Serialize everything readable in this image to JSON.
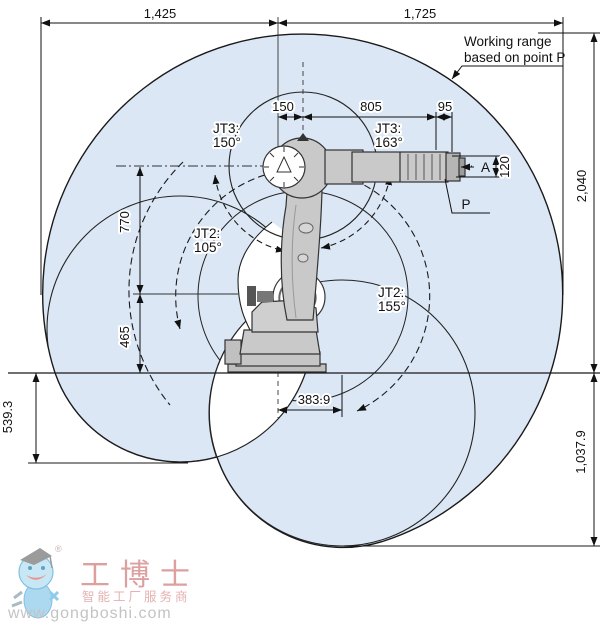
{
  "annotations": {
    "working_range": [
      "Working range",
      "based on point P"
    ],
    "point_a": "A",
    "point_p": "P"
  },
  "dims": {
    "reach_back": "1,425",
    "reach_forward": "1,725",
    "jt1_offset": "150",
    "forearm": "805",
    "wrist_to_p": "95",
    "flange_width": "120",
    "total_height": "2,040",
    "upper_arm": "770",
    "shoulder_height": "465",
    "depth_left": "539.3",
    "bottom_offset": "383.9",
    "depth_right": "1,037.9"
  },
  "joints": {
    "jt3_left": {
      "label": "JT3:",
      "angle": "150°"
    },
    "jt3_right": {
      "label": "JT3:",
      "angle": "163°"
    },
    "jt2_left": {
      "label": "JT2:",
      "angle": "105°"
    },
    "jt2_right": {
      "label": "JT2:",
      "angle": "155°"
    }
  },
  "watermark": {
    "reg": "®",
    "brand": "工博士",
    "tagline": "智能工厂服务商",
    "url": "www.gongboshi.com"
  },
  "colors": {
    "envelope_fill": "#dbe7f5",
    "outline": "#1a1a1a",
    "robot_fill": "#c9c9c9",
    "robot_dark": "#9d9d9d",
    "watermark_red": "#d98f8f",
    "watermark_gray": "#b9b9b9",
    "watermark_blue": "#7cc3e8"
  }
}
